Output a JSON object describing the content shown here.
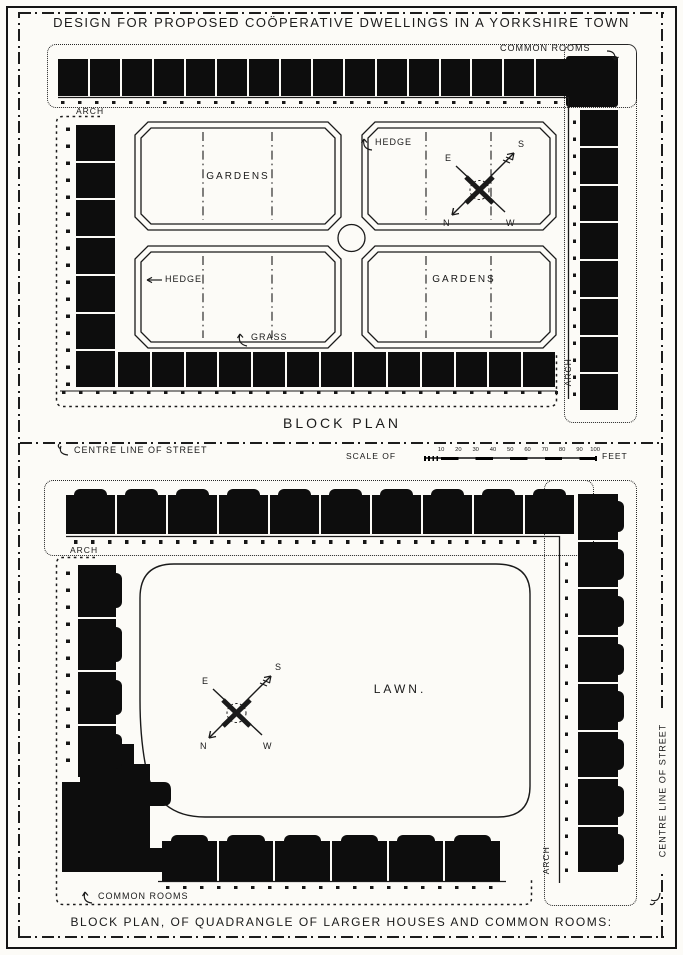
{
  "page": {
    "title": "DESIGN FOR PROPOSED COÖPERATIVE DWELLINGS IN A YORKSHIRE TOWN"
  },
  "colors": {
    "ink": "#141414",
    "paper": "#fcfbf7"
  },
  "top_plan": {
    "caption": "BLOCK PLAN",
    "labels": {
      "common_rooms": "COMMON ROOMS",
      "arch_left": "ARCH",
      "arch_right": "ARCH",
      "gardens_upper": "GARDENS",
      "gardens_lower": "GARDENS",
      "hedge_upper": "HEDGE",
      "hedge_lower": "HEDGE",
      "grass": "GRASS"
    },
    "compass": {
      "n": "N",
      "s": "S",
      "e": "E",
      "w": "W"
    },
    "units": {
      "top_row": 16,
      "right_column": 8,
      "left_column": 7,
      "bottom_row": 13
    }
  },
  "street": {
    "centre_line_label": "CENTRE LINE OF STREET",
    "scale": {
      "prefix": "SCALE OF",
      "suffix": "FEET",
      "ticks": [
        "10",
        "20",
        "30",
        "40",
        "50",
        "60",
        "70",
        "80",
        "90",
        "100"
      ]
    }
  },
  "bottom_plan": {
    "caption": "BLOCK PLAN, OF QUADRANGLE OF LARGER HOUSES AND COMMON ROOMS:",
    "labels": {
      "arch_top": "ARCH",
      "arch_bottom": "ARCH",
      "lawn": "LAWN.",
      "common_rooms": "COMMON ROOMS",
      "centre_line_right": "CENTRE LINE OF STREET"
    },
    "compass": {
      "n": "N",
      "s": "S",
      "e": "E",
      "w": "W"
    },
    "units": {
      "top_row": 10,
      "right_column": 8,
      "left_column": 4,
      "bottom_row": 6
    }
  }
}
